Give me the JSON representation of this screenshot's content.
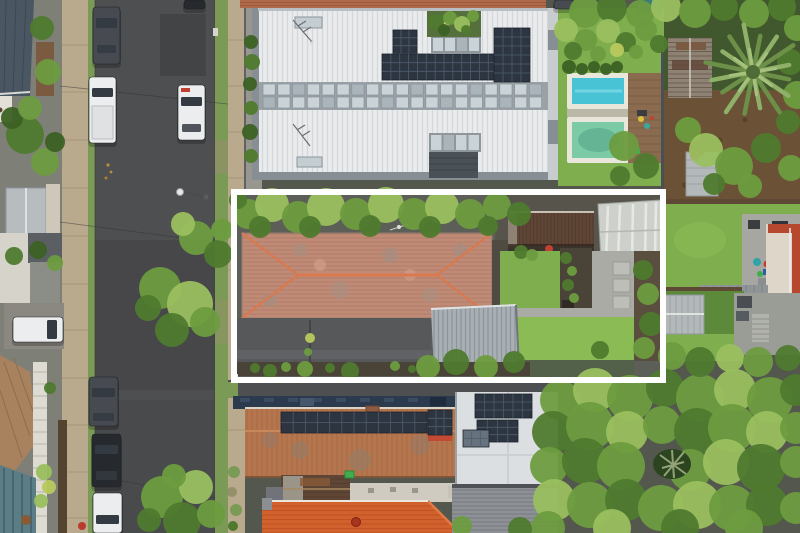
{
  "image": {
    "kind": "aerial-drone-photo",
    "description": "Top-down aerial photo of a residential street; a white rectangular outline highlights one property with a weathered terracotta hip roof, grey metal garage, rear lawns and sheds. A large white modern roof with solar panels and two pools sits above; terracotta-roof houses below; road with parked cars on the left; dense tree canopy lower right; palm tree upper right.",
    "width": 800,
    "height": 533
  },
  "palette": {
    "road": "#4e4f51",
    "roadDark": "#434446",
    "sidewalk": "#b9a98d",
    "sidewalkLine": "#a3916f",
    "verge": "#7b9a55",
    "vergeDry": "#94906a",
    "lawn": "#7fae4e",
    "lawnBright": "#8abb55",
    "lawnShade": "#5d8a3a",
    "treeLight": "#9abf5f",
    "tree": "#6d9c3f",
    "treeDark": "#4f7a2e",
    "treeDeep": "#3c6124",
    "treeYellow": "#b9c95e",
    "whiteRoof": "#e9ebec",
    "whiteRoofRib": "#d4d8db",
    "roofEdge": "#878e94",
    "clerestory": "#9aa1a7",
    "windowGlass": "#c9d3d8",
    "windowGlassDark": "#a9b5bb",
    "solar": "#2c3540",
    "solarLine": "#4f5c6e",
    "solarPale": "#66727e",
    "redTile": "#c08b76",
    "redTileLine": "#a87864",
    "redRidge": "#da794f",
    "garage": "#a9b0b5",
    "garageRib": "#8d959b",
    "rust": "#5f4536",
    "rustLight": "#8d8274",
    "rustDark": "#4e3a2c",
    "paleRoof": "#ced1cb",
    "poolWater": "#47c3d5",
    "poolWater2": "#7ccba6",
    "poolEdge": "#e9e6db",
    "deck": "#8a6b4f",
    "navy": "#2c3a4e",
    "oldTerra": "#b5764e",
    "oldTerraLine": "#9d6440",
    "orange": "#d2612d",
    "orangeLine": "#bd5124",
    "cream": "#ddd6c9",
    "redEdge": "#b5482e",
    "palmFrond": "#8fb068",
    "palmFrondDark": "#6d9048",
    "palmCore": "#4e6b38",
    "dirt": "#6b5236",
    "dirtDark": "#584329",
    "concrete": "#a9aba4",
    "paver": "#bcbeb7",
    "patio": "#a6a7a1",
    "walkway": "#8f9496",
    "shed": "#b3b8ba",
    "shedLine": "#9ca2a5",
    "soil": "#4a4438",
    "fenceBrown": "#5e4936",
    "carWhite": "#ecedef",
    "carDark": "#474b51",
    "carBlack": "#26292d",
    "glass": "#343a41",
    "slate": "#4b5663",
    "grayRoof": "#8d9196",
    "grayRoofLine": "#767a7f",
    "awning": "#5b7d86",
    "awningLine": "#49656e",
    "tealTank": "#3f7e74",
    "white": "#ffffff"
  },
  "scene": {
    "outline": {
      "x": 234,
      "y": 192,
      "width": 429,
      "height": 188,
      "stroke_width": 6,
      "color": "white"
    },
    "palm": {
      "cx": 753,
      "cy": 72,
      "fronds": 16,
      "len": 46
    },
    "window_band": {
      "x": 263,
      "y1": 84,
      "y2": 97,
      "cells": 19,
      "w": 12.2,
      "gap": 2.6,
      "h": 11
    },
    "trees": [
      [
        585,
        12,
        16,
        "tree"
      ],
      [
        612,
        8,
        15,
        "treeDark"
      ],
      [
        640,
        14,
        14,
        "tree"
      ],
      [
        666,
        7,
        15,
        "treeLight"
      ],
      [
        695,
        12,
        16,
        "tree"
      ],
      [
        724,
        7,
        14,
        "treeDark"
      ],
      [
        754,
        13,
        15,
        "tree"
      ],
      [
        782,
        7,
        14,
        "treeDark"
      ],
      [
        797,
        28,
        13,
        "tree"
      ],
      [
        790,
        62,
        13,
        "treeDark"
      ],
      [
        797,
        95,
        14,
        "tree"
      ],
      [
        788,
        122,
        12,
        "treeDark"
      ],
      [
        566,
        30,
        12,
        "treeLight"
      ],
      [
        586,
        40,
        11,
        "tree"
      ],
      [
        608,
        31,
        12,
        "treeLight"
      ],
      [
        626,
        42,
        10,
        "treeDark"
      ],
      [
        646,
        30,
        11,
        "tree"
      ],
      [
        659,
        44,
        9,
        "treeDark"
      ],
      [
        573,
        51,
        9,
        "treeDark"
      ],
      [
        598,
        54,
        8,
        "tree"
      ],
      [
        617,
        50,
        7,
        "treeYellow"
      ],
      [
        636,
        52,
        7,
        "tree"
      ],
      [
        569,
        67,
        7,
        "treeDeep"
      ],
      [
        582,
        69,
        6,
        "treeDeep"
      ],
      [
        594,
        67,
        6,
        "treeDeep"
      ],
      [
        606,
        69,
        6,
        "treeDeep"
      ],
      [
        617,
        67,
        6,
        "treeDeep"
      ],
      [
        624,
        146,
        15,
        "tree"
      ],
      [
        646,
        166,
        13,
        "treeDark"
      ],
      [
        688,
        130,
        13,
        "tree"
      ],
      [
        706,
        150,
        17,
        "treeLight"
      ],
      [
        734,
        166,
        19,
        "tree"
      ],
      [
        766,
        148,
        15,
        "treeDark"
      ],
      [
        791,
        168,
        13,
        "tree"
      ],
      [
        714,
        184,
        11,
        "treeDark"
      ],
      [
        750,
        186,
        12,
        "tree"
      ],
      [
        620,
        176,
        10,
        "treeDark"
      ],
      [
        251,
        42,
        7,
        "treeDeep"
      ],
      [
        252,
        62,
        8,
        "treeDark"
      ],
      [
        250,
        84,
        7,
        "treeDeep"
      ],
      [
        251,
        108,
        7,
        "treeDark"
      ],
      [
        250,
        132,
        8,
        "treeDeep"
      ],
      [
        251,
        156,
        7,
        "treeDark"
      ],
      [
        436,
        22,
        8,
        "treeDark"
      ],
      [
        450,
        18,
        7,
        "tree"
      ],
      [
        462,
        24,
        8,
        "treeLight"
      ],
      [
        473,
        16,
        6,
        "tree"
      ],
      [
        444,
        30,
        6,
        "treeDeep"
      ],
      [
        466,
        30,
        5,
        "treeDark"
      ],
      [
        248,
        214,
        15,
        "tree"
      ],
      [
        272,
        205,
        17,
        "treeLight"
      ],
      [
        298,
        217,
        16,
        "tree"
      ],
      [
        326,
        207,
        19,
        "treeLight"
      ],
      [
        356,
        214,
        16,
        "tree"
      ],
      [
        386,
        205,
        18,
        "treeLight"
      ],
      [
        414,
        214,
        16,
        "tree"
      ],
      [
        442,
        207,
        17,
        "treeLight"
      ],
      [
        470,
        214,
        15,
        "tree"
      ],
      [
        497,
        206,
        14,
        "tree"
      ],
      [
        519,
        214,
        12,
        "treeDark"
      ],
      [
        260,
        227,
        11,
        "treeDark"
      ],
      [
        310,
        227,
        11,
        "treeDark"
      ],
      [
        370,
        226,
        11,
        "treeDark"
      ],
      [
        430,
        227,
        11,
        "treeDark"
      ],
      [
        488,
        226,
        10,
        "treeDark"
      ],
      [
        238,
        200,
        9,
        "treeDark"
      ],
      [
        643,
        270,
        10,
        "treeDark"
      ],
      [
        648,
        294,
        11,
        "tree"
      ],
      [
        651,
        324,
        12,
        "treeDark"
      ],
      [
        644,
        348,
        11,
        "tree"
      ],
      [
        600,
        350,
        9,
        "treeDark"
      ],
      [
        521,
        252,
        7,
        "treeDark"
      ],
      [
        532,
        255,
        6,
        "tree"
      ],
      [
        566,
        258,
        6,
        "treeDark"
      ],
      [
        572,
        271,
        5,
        "tree"
      ],
      [
        568,
        285,
        6,
        "treeDark"
      ],
      [
        574,
        298,
        5,
        "tree"
      ],
      [
        428,
        367,
        12,
        "tree"
      ],
      [
        456,
        362,
        13,
        "treeDark"
      ],
      [
        486,
        367,
        12,
        "tree"
      ],
      [
        514,
        362,
        11,
        "treeDark"
      ],
      [
        350,
        371,
        9,
        "treeDark"
      ],
      [
        305,
        369,
        8,
        "tree"
      ],
      [
        270,
        371,
        7,
        "treeDark"
      ],
      [
        255,
        368,
        5,
        "treeDark"
      ],
      [
        286,
        367,
        5,
        "tree"
      ],
      [
        330,
        368,
        5,
        "treeDark"
      ],
      [
        395,
        366,
        5,
        "tree"
      ],
      [
        412,
        369,
        4,
        "treeDark"
      ],
      [
        310,
        338,
        5,
        "treeYellow"
      ],
      [
        308,
        352,
        4,
        "tree"
      ],
      [
        160,
        288,
        21,
        "tree"
      ],
      [
        190,
        304,
        23,
        "treeLight"
      ],
      [
        172,
        330,
        17,
        "treeDark"
      ],
      [
        205,
        322,
        15,
        "tree"
      ],
      [
        148,
        308,
        13,
        "treeDark"
      ],
      [
        196,
        238,
        17,
        "tree"
      ],
      [
        218,
        254,
        14,
        "treeDark"
      ],
      [
        183,
        224,
        12,
        "treeLight"
      ],
      [
        222,
        230,
        11,
        "tree"
      ],
      [
        162,
        497,
        21,
        "tree"
      ],
      [
        196,
        487,
        17,
        "treeLight"
      ],
      [
        182,
        521,
        19,
        "treeDark"
      ],
      [
        211,
        514,
        14,
        "tree"
      ],
      [
        149,
        520,
        12,
        "treeDark"
      ],
      [
        174,
        476,
        12,
        "tree"
      ],
      [
        42,
        28,
        12,
        "treeDark"
      ],
      [
        48,
        72,
        13,
        "tree"
      ],
      [
        25,
        135,
        19,
        "treeDark"
      ],
      [
        45,
        162,
        14,
        "tree"
      ],
      [
        12,
        118,
        11,
        "treeDeep"
      ],
      [
        30,
        108,
        12,
        "tree"
      ],
      [
        55,
        142,
        10,
        "treeDeep"
      ],
      [
        14,
        256,
        9,
        "treeDark"
      ],
      [
        38,
        250,
        9,
        "treeDeep"
      ],
      [
        55,
        263,
        8,
        "tree"
      ],
      [
        44,
        472,
        8,
        "treeLight"
      ],
      [
        49,
        487,
        7,
        "treeYellow"
      ],
      [
        41,
        501,
        7,
        "treeLight"
      ],
      [
        50,
        388,
        6,
        "treeDark"
      ],
      [
        560,
        400,
        20,
        "tree"
      ],
      [
        595,
        390,
        22,
        "treeLight"
      ],
      [
        630,
        398,
        23,
        "tree"
      ],
      [
        665,
        388,
        19,
        "treeDark"
      ],
      [
        700,
        398,
        24,
        "tree"
      ],
      [
        735,
        390,
        21,
        "treeLight"
      ],
      [
        770,
        400,
        23,
        "tree"
      ],
      [
        796,
        390,
        16,
        "treeDark"
      ],
      [
        553,
        432,
        21,
        "treeDark"
      ],
      [
        590,
        426,
        24,
        "tree"
      ],
      [
        627,
        432,
        21,
        "treeLight"
      ],
      [
        662,
        425,
        19,
        "tree"
      ],
      [
        697,
        431,
        23,
        "treeDark"
      ],
      [
        732,
        428,
        24,
        "tree"
      ],
      [
        767,
        432,
        21,
        "treeLight"
      ],
      [
        796,
        428,
        16,
        "tree"
      ],
      [
        549,
        466,
        19,
        "tree"
      ],
      [
        585,
        461,
        23,
        "treeDark"
      ],
      [
        621,
        466,
        24,
        "tree"
      ],
      [
        690,
        470,
        21,
        "tree"
      ],
      [
        726,
        462,
        23,
        "treeLight"
      ],
      [
        761,
        468,
        24,
        "treeDark"
      ],
      [
        796,
        462,
        16,
        "tree"
      ],
      [
        554,
        500,
        21,
        "treeLight"
      ],
      [
        590,
        505,
        23,
        "tree"
      ],
      [
        626,
        500,
        21,
        "treeDark"
      ],
      [
        661,
        508,
        23,
        "tree"
      ],
      [
        697,
        505,
        24,
        "treeLight"
      ],
      [
        732,
        508,
        23,
        "tree"
      ],
      [
        767,
        505,
        21,
        "treeDark"
      ],
      [
        796,
        508,
        16,
        "tree"
      ],
      [
        548,
        528,
        17,
        "tree"
      ],
      [
        612,
        528,
        19,
        "treeLight"
      ],
      [
        680,
        528,
        19,
        "treeDark"
      ],
      [
        744,
        528,
        19,
        "tree"
      ],
      [
        462,
        526,
        10,
        "tree"
      ],
      [
        520,
        529,
        12,
        "treeDark"
      ],
      [
        672,
        356,
        14,
        "tree"
      ],
      [
        700,
        362,
        15,
        "treeDark"
      ],
      [
        730,
        358,
        14,
        "treeLight"
      ],
      [
        758,
        362,
        15,
        "tree"
      ],
      [
        788,
        358,
        13,
        "treeDark"
      ]
    ],
    "cars": [
      {
        "c": "carDark",
        "body": [
          93,
          7,
          27,
          57
        ],
        "glass": [
          96,
          18,
          21,
          10
        ],
        "glass2": [
          97,
          45,
          19,
          8
        ]
      },
      {
        "c": "carWhite",
        "body": [
          89,
          77,
          27,
          66
        ],
        "glass": [
          92,
          88,
          21,
          9
        ],
        "bed": [
          92,
          106,
          21,
          33
        ]
      },
      {
        "c": "carWhite",
        "body": [
          178,
          85,
          27,
          55
        ],
        "glass": [
          181,
          97,
          21,
          9
        ],
        "glass2": [
          182,
          124,
          19,
          8
        ],
        "accent": [
          181,
          88,
          9,
          4
        ]
      },
      {
        "c": "carBlack",
        "body": [
          184,
          0,
          21,
          9
        ]
      },
      {
        "c": "carDark",
        "body": [
          554,
          0,
          20,
          9
        ]
      },
      {
        "c": "carWhite",
        "body": [
          13,
          317,
          50,
          25
        ],
        "glass": [
          47,
          320,
          10,
          19
        ]
      },
      {
        "c": "carDark",
        "body": [
          89,
          377,
          29,
          49
        ],
        "glass": [
          92,
          388,
          23,
          9
        ],
        "glass2": [
          93,
          413,
          21,
          8
        ]
      },
      {
        "c": "carBlack",
        "body": [
          92,
          434,
          29,
          53
        ],
        "glass": [
          95,
          445,
          23,
          9
        ],
        "glass2": [
          96,
          471,
          21,
          9
        ]
      },
      {
        "c": "carWhite",
        "body": [
          93,
          493,
          29,
          40
        ],
        "glass": [
          96,
          515,
          23,
          9
        ]
      }
    ],
    "solar_arrays": [
      [
        393,
        30,
        24,
        47,
        6,
        3
      ],
      [
        382,
        54,
        124,
        26,
        3,
        14
      ],
      [
        494,
        28,
        36,
        54,
        6,
        4
      ],
      [
        281,
        412,
        146,
        21,
        2,
        12
      ],
      [
        428,
        410,
        24,
        25,
        3,
        3
      ],
      [
        475,
        394,
        57,
        24,
        3,
        6
      ],
      [
        477,
        420,
        41,
        22,
        3,
        4
      ],
      [
        463,
        430,
        26,
        17,
        2,
        3,
        "solarPale"
      ]
    ]
  }
}
